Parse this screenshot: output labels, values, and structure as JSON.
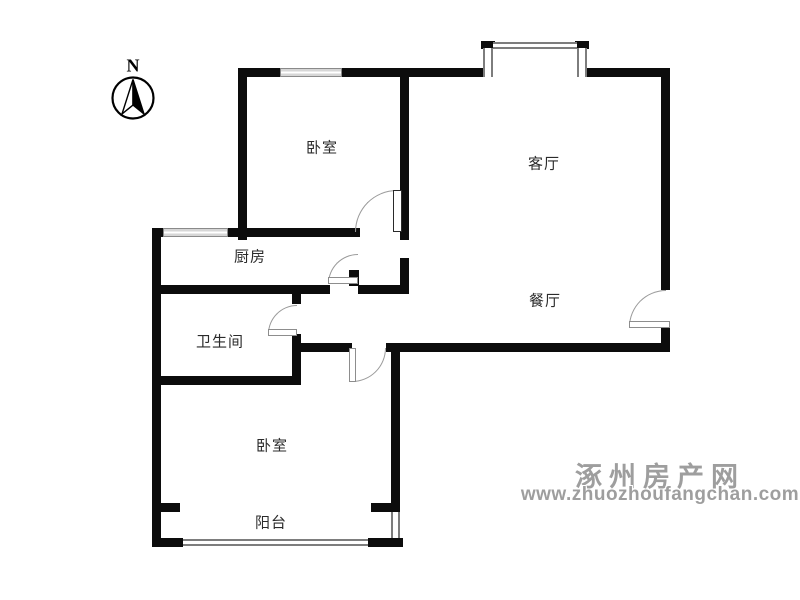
{
  "compass": {
    "north_label": "N"
  },
  "rooms": [
    {
      "id": "bedroom-top",
      "name": "卧室"
    },
    {
      "id": "living-room",
      "name": "客厅"
    },
    {
      "id": "kitchen",
      "name": "厨房"
    },
    {
      "id": "bathroom",
      "name": "卫生间"
    },
    {
      "id": "dining-room",
      "name": "餐厅"
    },
    {
      "id": "bedroom-bottom",
      "name": "卧室"
    },
    {
      "id": "balcony",
      "name": "阳台"
    }
  ],
  "watermark": {
    "site_name": "涿州房产网",
    "site_url": "www.zhuozhoufangchan.com",
    "color": "#9e9e9e"
  },
  "colors": {
    "wall": "#0c0c0c",
    "door_arc": "#9a9a9a",
    "window_fill": "#dcdcdc"
  }
}
